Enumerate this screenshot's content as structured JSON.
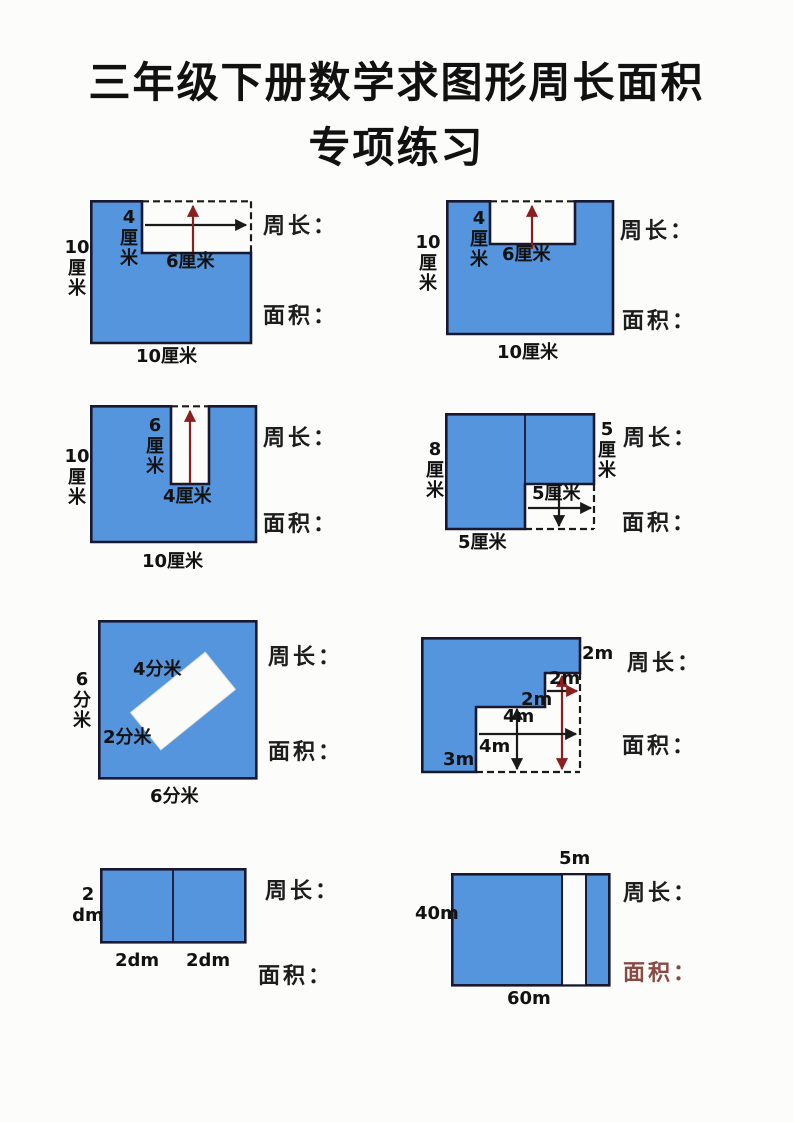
{
  "title": {
    "line1": "三年级下册数学求图形周长面积",
    "line2": "专项练习"
  },
  "prompts": {
    "perimeter": "周长：",
    "area": "面积："
  },
  "colors": {
    "shape_fill": "#5595dd",
    "shape_border": "#181830",
    "dash_line": "#1a1a1a",
    "arrow_black": "#1a1a1a",
    "arrow_red": "#8b1f1f",
    "area_label_maroon": "#8a4a42"
  },
  "figures": [
    {
      "desc": "square with notch cut from top-right corner",
      "left": "10\n厘\n米",
      "bottom": "10厘米",
      "notch_height": "4\n厘\n米",
      "notch_width": "6厘米"
    },
    {
      "desc": "square with notch cut from top-middle",
      "left": "10\n厘\n米",
      "bottom": "10厘米",
      "notch_height": "4\n厘\n米",
      "notch_width": "6厘米"
    },
    {
      "desc": "square with deep slot cut from top",
      "left": "10\n厘\n米",
      "bottom": "10厘米",
      "slot_depth": "6\n厘\n米",
      "slot_width": "4厘米"
    },
    {
      "desc": "L-shape, bottom-right corner cut",
      "left": "8\n厘\n米",
      "right": "5\n厘\n米",
      "bottom": "5厘米",
      "cutout": "5厘米"
    },
    {
      "desc": "square with rotated white rectangle",
      "left": "6\n分\n米",
      "bottom": "6分米",
      "rect_long": "4分米",
      "rect_short": "2分米"
    },
    {
      "desc": "staircase shape",
      "top_right": "2m",
      "notch": "2m",
      "step": "2m",
      "mid_height": "4m",
      "mid_width": "4m",
      "bottom_left": "3m"
    },
    {
      "desc": "rectangle of two squares",
      "left": "2\ndm",
      "bottom_left": "2dm",
      "bottom_right": "2dm"
    },
    {
      "desc": "rectangle with vertical white strip",
      "top": "5m",
      "left": "40m",
      "bottom": "60m"
    }
  ]
}
